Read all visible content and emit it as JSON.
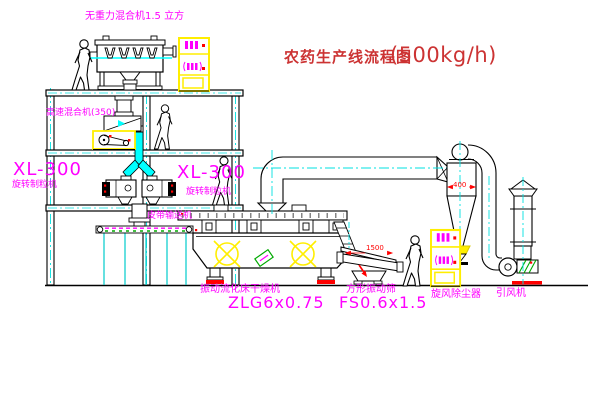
{
  "title": {
    "name_cn": "农药生产线流程图",
    "capacity": "(500kg/h)"
  },
  "labels": {
    "gravity_mixer": "无重力混合机1.5 立方",
    "high_speed_mixer": "高速混合机(350)",
    "granulator_left_model": "XL-300",
    "granulator_left_name": "旋转制粒机",
    "granulator_right_model": "XL-300",
    "granulator_right_name": "旋转制粒机",
    "belt_conveyor": "皮带输送机",
    "dryer_name": "振动流化床干燥机",
    "dryer_model": "ZLG6x0.75",
    "screen_name": "方形振动筛",
    "screen_model": "FS0.6x1.5",
    "cyclone_name": "旋风除尘器",
    "fan_name": "引风机"
  },
  "dimensions": {
    "screen_length": "1500",
    "cyclone_width": "400"
  },
  "colors": {
    "label_magenta": "#ff00ff",
    "title_red": "#cc3333",
    "centerline_cyan": "#00e0e0",
    "pipe_cyan": "#00ffff",
    "highlight_yellow": "#ffee00",
    "accent_red": "#ff0000",
    "machine_green": "#00aa00"
  }
}
